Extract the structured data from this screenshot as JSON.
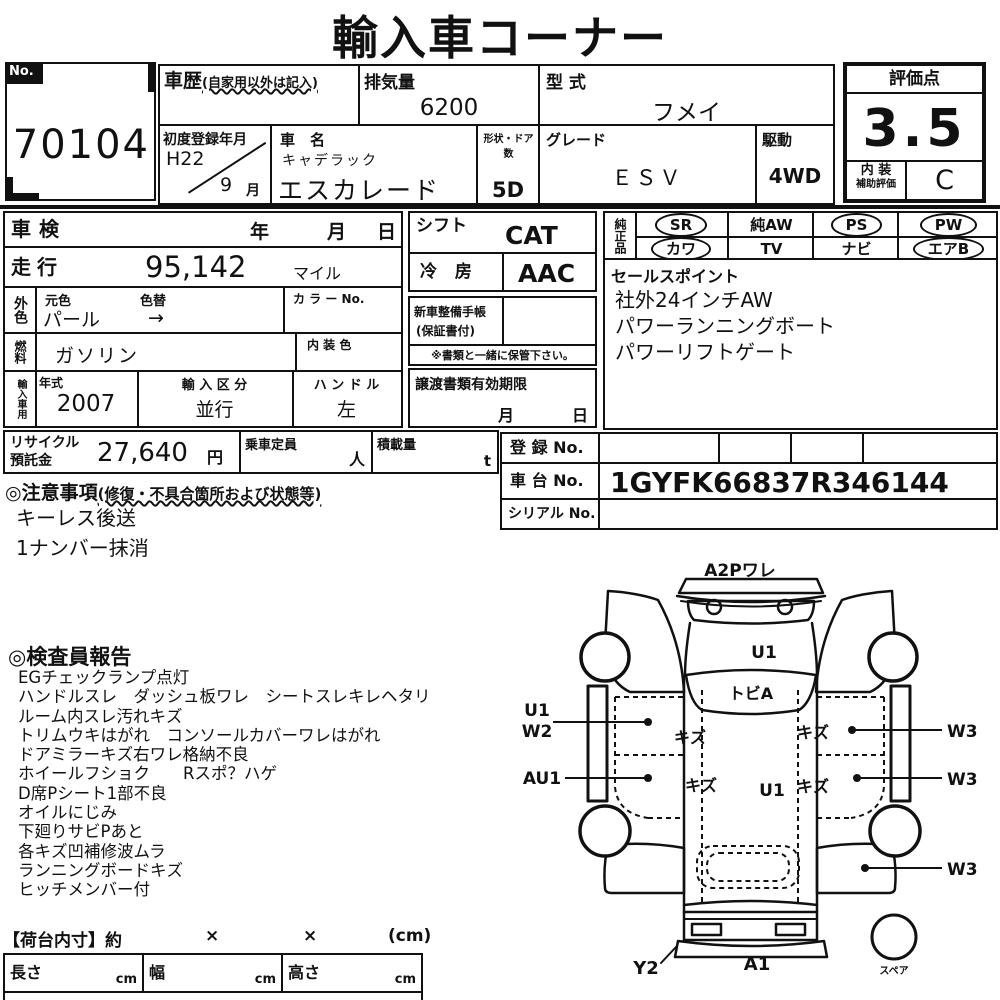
{
  "title": "輸入車コーナー",
  "header": {
    "no_label": "No.",
    "no_value": "70104",
    "history_label": "車歴",
    "history_note": "(自家用以外は記入)",
    "displacement_label": "排気量",
    "displacement_value": "6200",
    "model_code_label": "型 式",
    "model_code_value": "フメイ",
    "first_reg_label": "初度登録年月",
    "first_reg_era": "H22",
    "first_reg_month": "9",
    "month_suffix": "月",
    "car_name_label": "車　名",
    "car_maker": "キャデラック",
    "car_model": "エスカレード",
    "doors_label": "形状・ドア数",
    "doors_value": "5D",
    "grade_label": "グレード",
    "grade_value": "ＥＳＶ",
    "drive_label": "駆動",
    "drive_value": "4WD",
    "rating_label": "評価点",
    "rating_value": "3.5",
    "interior_label_top": "内 装",
    "interior_label_bottom": "補助評価",
    "interior_value": "C"
  },
  "left": {
    "shaken_label": "車検",
    "year_label": "年",
    "month_label": "月",
    "day_label": "日",
    "mileage_label": "走行",
    "mileage_value": "95,142",
    "mileage_unit": "マイル",
    "ext_color_label": "外色",
    "orig_color_label": "元色",
    "orig_color_value": "パール",
    "color_change_label": "色替",
    "color_change_value": "→",
    "color_no_label": "カ ラ ー No.",
    "fuel_label": "燃料",
    "fuel_value": "ガソリン",
    "interior_color_label": "内 装 色",
    "import_label": "輸入車用",
    "year_model_label": "年式",
    "year_model_value": "2007",
    "import_class_label": "輸 入 区 分",
    "import_class_value": "並行",
    "handle_label": "ハ ン ド ル",
    "handle_value": "左"
  },
  "middle": {
    "shift_label": "シフト",
    "shift_value": "CAT",
    "ac_label": "冷 房",
    "ac_value": "AAC",
    "techo_label": "新車整備手帳",
    "techo_note": "(保証書付)",
    "keep_note": "※書類と一緒に保管下さい。",
    "transfer_label": "譲渡書類有効期限",
    "transfer_month": "月",
    "transfer_day": "日"
  },
  "equipment": {
    "label": "純正品",
    "items": [
      {
        "label": "SR",
        "circled": true
      },
      {
        "label": "純AW",
        "circled": false
      },
      {
        "label": "PS",
        "circled": true
      },
      {
        "label": "PW",
        "circled": true
      },
      {
        "label": "カワ",
        "circled": true
      },
      {
        "label": "TV",
        "circled": false
      },
      {
        "label": "ナビ",
        "circled": false
      },
      {
        "label": "エアB",
        "circled": true
      }
    ]
  },
  "sales_point": {
    "label": "セールスポイント",
    "lines": [
      "社外24インチAW",
      "パワーランニングボート",
      "パワーリフトゲート"
    ]
  },
  "registration": {
    "reg_no_label": "登 録 No.",
    "reg_no_value": "",
    "chassis_label": "車 台 No.",
    "chassis_value": "1GYFK66837R346144",
    "serial_label": "シリアル No.",
    "serial_value": ""
  },
  "recycle": {
    "label_line1": "リサイクル",
    "label_line2": "預託金",
    "value": "27,640",
    "unit": "円"
  },
  "capacity": {
    "label": "乗車定員",
    "unit": "人"
  },
  "load": {
    "label": "積載量",
    "unit": "t"
  },
  "notes": {
    "heading": "◎注意事項",
    "heading_note": "(修復・不具合箇所および状態等)",
    "lines": [
      "キーレス後送",
      "1ナンバー抹消"
    ]
  },
  "inspector": {
    "heading": "◎検査員報告",
    "lines": [
      "EGチェックランプ点灯",
      "ハンドルスレ　ダッシュ板ワレ　シートスレキレヘタリ",
      "ルーム内スレ汚れキズ",
      "トリムウキはがれ　コンソールカバーワレはがれ",
      "ドアミラーキズ右ワレ格納不良",
      "ホイールフショク　　Rスポ？ハゲ",
      "D席Pシート1部不良",
      "オイルにじみ",
      "下廻りサビPあと",
      "各キズ凹補修波ムラ",
      "ランニングボードキズ",
      "ヒッチメンバー付"
    ]
  },
  "cargo": {
    "heading": "【荷台内寸】約",
    "x1": "×",
    "x2": "×",
    "unit_note": "(cm)",
    "cells": [
      {
        "label": "長さ",
        "unit": "cm"
      },
      {
        "label": "幅",
        "unit": "cm"
      },
      {
        "label": "高さ",
        "unit": "cm"
      }
    ]
  },
  "diagram": {
    "top_label": "A2Pワレ",
    "hood_label": "U1",
    "windshield_label": "トビA",
    "left_label_1a": "U1",
    "left_label_1b": "W2",
    "left_label_2": "AU1",
    "right_label_1": "W3",
    "right_label_2": "W3",
    "right_label_3": "W3",
    "scratch_front_left": "キズ",
    "scratch_front_right": "キズ",
    "scratch_rear_left": "キズ",
    "scratch_rear_right": "キズ",
    "center_label": "U1",
    "rear_corner_label": "Y2",
    "rear_bumper_label": "A1",
    "spare_label": "スペア"
  },
  "colors": {
    "ink": "#111111",
    "paper": "#ffffff"
  }
}
